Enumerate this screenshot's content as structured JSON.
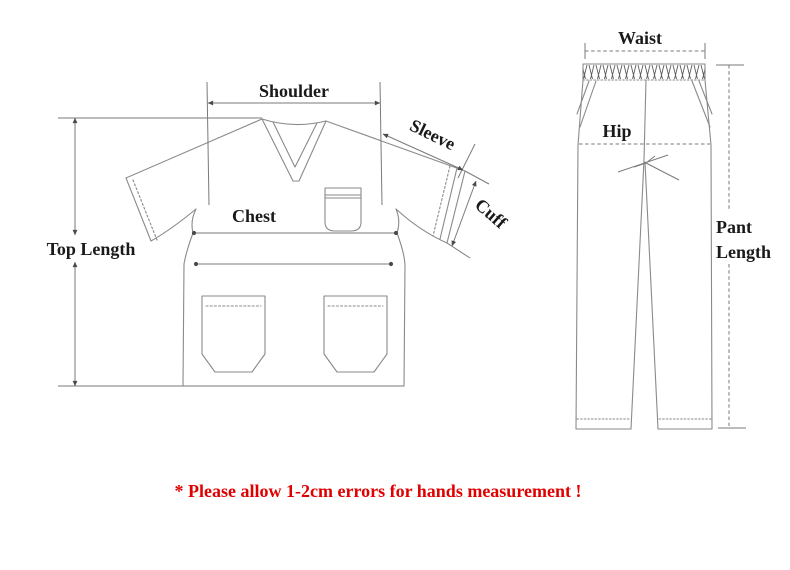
{
  "title": "Clothing size measurement diagram",
  "colors": {
    "line": "#8a8a8a",
    "dimension_line": "#7a7a7a",
    "label_text": "#1a1a1a",
    "note_red": "#e00000",
    "background": "#ffffff"
  },
  "top_garment": {
    "name": "scrub-top",
    "labels": {
      "shoulder": "Shoulder",
      "sleeve": "Sleeve",
      "cuff": "Cuff",
      "chest": "Chest",
      "top_length": "Top Length"
    }
  },
  "pants_garment": {
    "name": "scrub-pants",
    "labels": {
      "waist": "Waist",
      "hip": "Hip",
      "pant_length_line1": "Pant",
      "pant_length_line2": "Length"
    }
  },
  "note": {
    "text": "* Please allow 1-2cm errors for hands measurement !"
  }
}
